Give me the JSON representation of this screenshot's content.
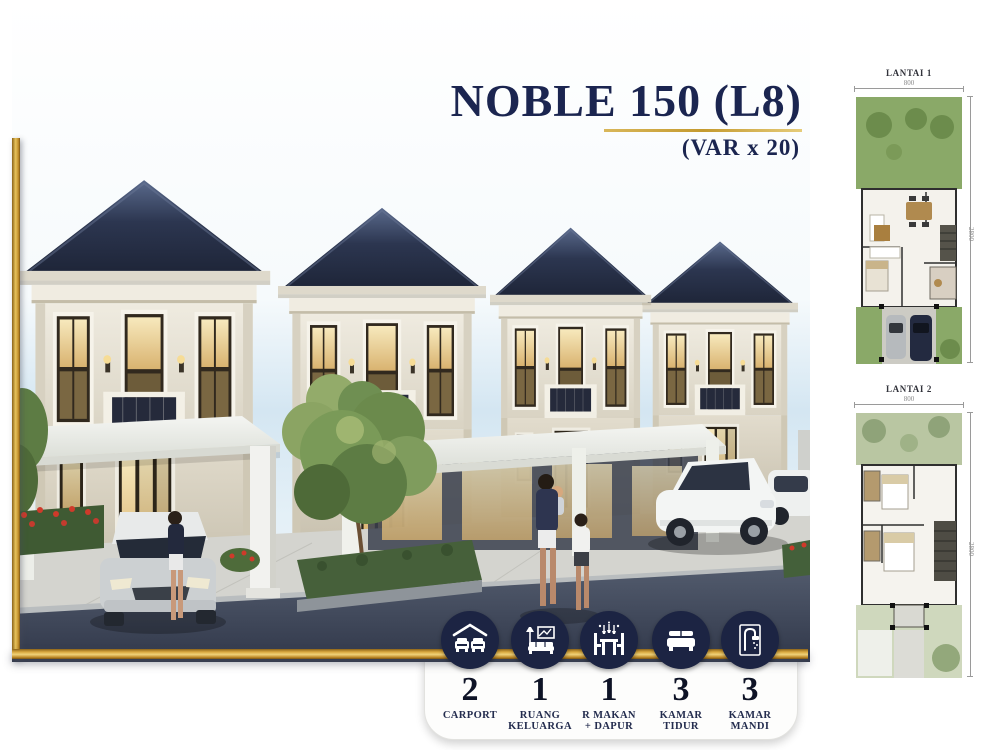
{
  "title": {
    "main": "NOBLE 150 (L8)",
    "variant": "(VAR x 20)"
  },
  "floor_plans": [
    {
      "label": "LANTAI 1",
      "width_dim": "800",
      "depth_dim": "2800"
    },
    {
      "label": "LANTAI 2",
      "width_dim": "800",
      "depth_dim": "2800"
    }
  ],
  "specs": [
    {
      "icon": "carport-icon",
      "count": "2",
      "label_lines": [
        "CARPORT"
      ]
    },
    {
      "icon": "living-room-icon",
      "count": "1",
      "label_lines": [
        "RUANG",
        "KELUARGA"
      ]
    },
    {
      "icon": "dining-kitchen-icon",
      "count": "1",
      "label_lines": [
        "R MAKAN",
        "+ DAPUR"
      ]
    },
    {
      "icon": "bed-icon",
      "count": "3",
      "label_lines": [
        "KAMAR",
        "TIDUR"
      ]
    },
    {
      "icon": "shower-icon",
      "count": "3",
      "label_lines": [
        "KAMAR",
        "MANDI"
      ]
    }
  ],
  "colors": {
    "accent_gold": "#c49a2f",
    "navy": "#1b2550",
    "icon_circle": "#1c2443"
  }
}
